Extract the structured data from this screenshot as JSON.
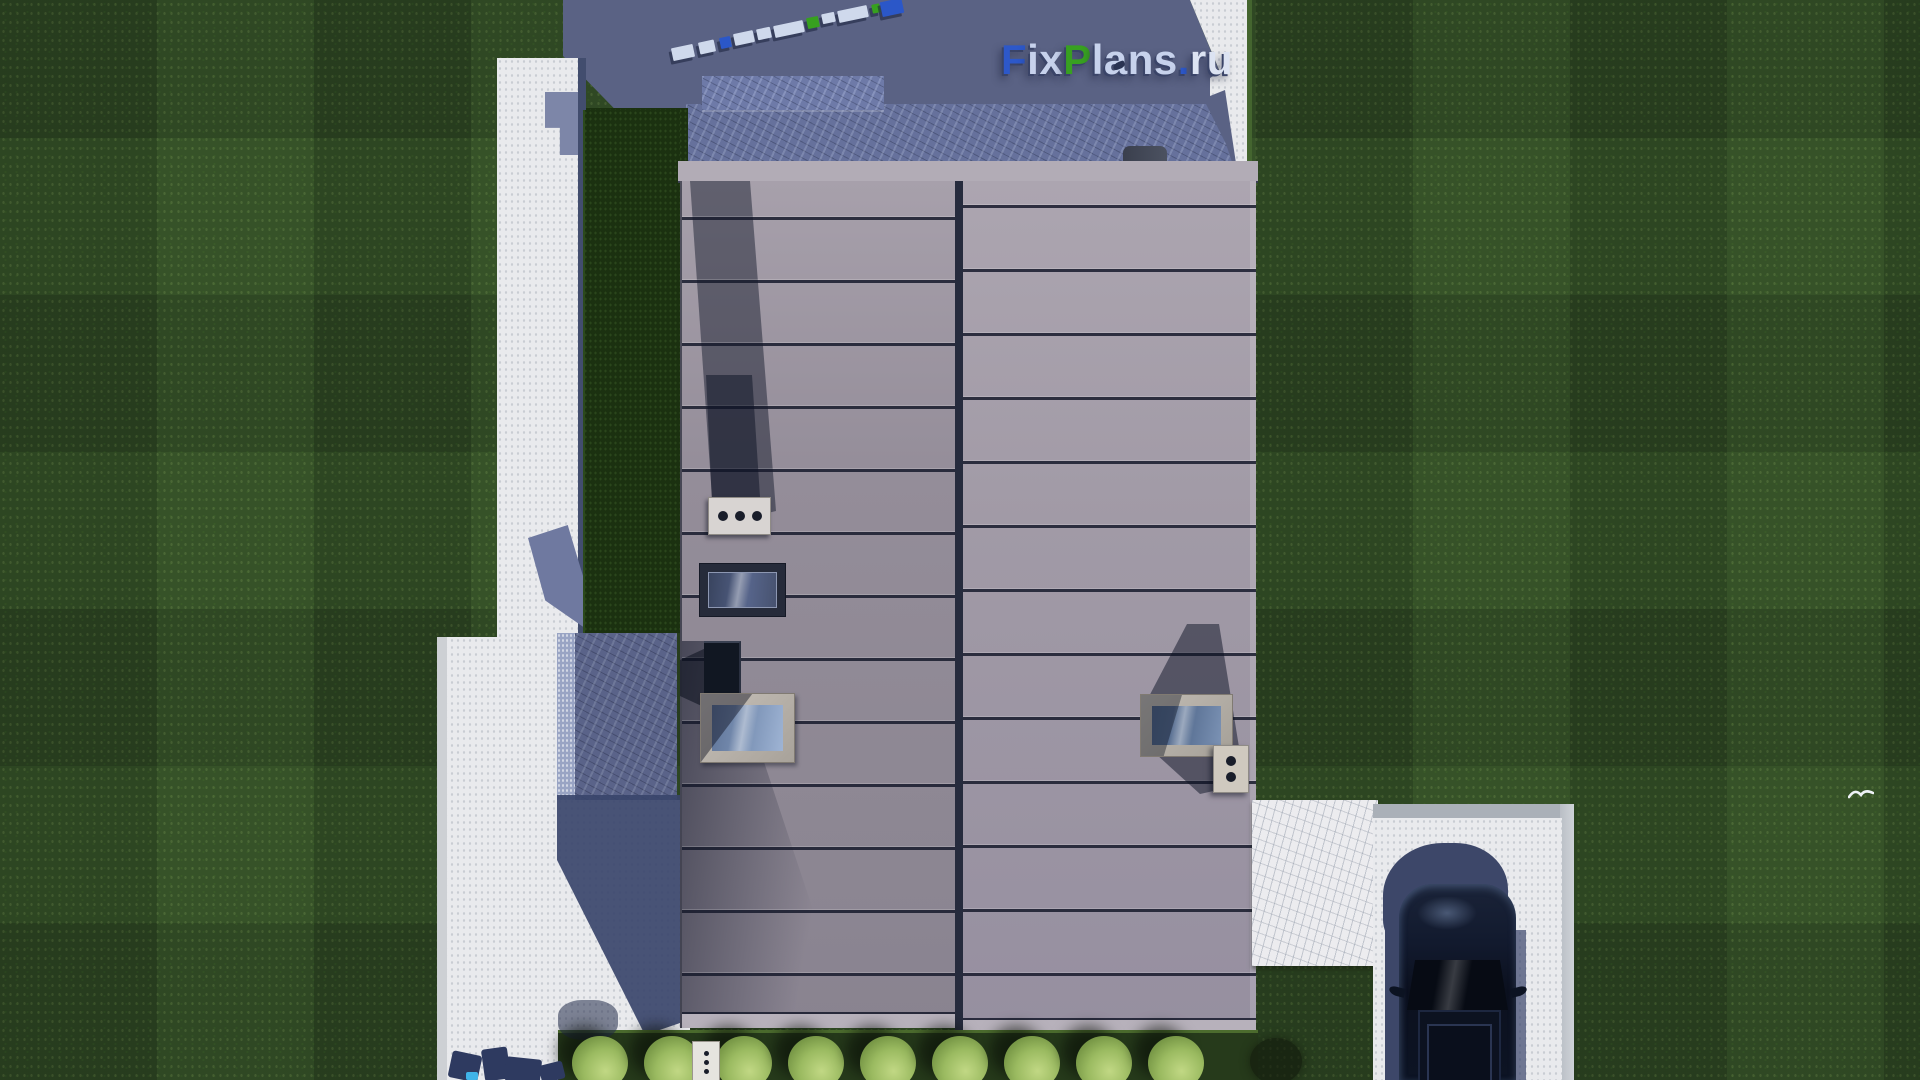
{
  "scene": {
    "description": "Aerial top-down 3D architectural render of a modern flat-roof house: two-section seamed metal roof with skylights and vents, white concrete paths, stone patios in shadow, lawn with mowing stripes, a row of trimmed shrubs, and a dark car parked on the driveway.",
    "watermark": {
      "full_text": "FixPlans.ru",
      "parts": [
        {
          "text": "F",
          "color": "#2d58c9"
        },
        {
          "text": "ix",
          "color": "#c7d2ec"
        },
        {
          "text": "P",
          "color": "#38a021"
        },
        {
          "text": "lans",
          "color": "#c7d2ec"
        },
        {
          "text": ".",
          "color": "#2d58c9"
        },
        {
          "text": "ru",
          "color": "#dce3f2"
        }
      ]
    },
    "colors": {
      "grass": "#2f4a24",
      "hedge": "#1b3110",
      "shadow": "#5a6284",
      "stone_shadowed": "#66719c",
      "path": "#e9eaed",
      "marble": "#ececef",
      "roof_left": "#948d99",
      "roof_right": "#a19aa6",
      "car_body": "#0d1424",
      "bush": "#9aba60",
      "logo_blue": "#2d58c9",
      "logo_green": "#38a021",
      "logo_light": "#c7d2ec"
    },
    "roof": {
      "left_seam_ys": [
        217,
        280,
        343,
        406,
        469,
        532,
        595,
        658,
        721,
        784,
        847,
        910,
        973
      ],
      "right_seam_ys": [
        205,
        269,
        333,
        397,
        461,
        525,
        589,
        653,
        717,
        781,
        845,
        909,
        973
      ],
      "left_vent_holes": 3,
      "right_vent_holes": 2,
      "bottom_vent_holes": 3
    },
    "landscaping": {
      "bush_count": 9,
      "bush_xs": [
        600,
        672,
        744,
        816,
        888,
        960,
        1032,
        1104,
        1176
      ]
    },
    "letters_3d": [
      {
        "x": 672,
        "y": 46,
        "w": 22,
        "h": 13,
        "c": "#cfd9ec"
      },
      {
        "x": 699,
        "y": 41,
        "w": 16,
        "h": 12,
        "c": "#cfd9ec"
      },
      {
        "x": 720,
        "y": 37,
        "w": 11,
        "h": 11,
        "c": "#2b57c8"
      },
      {
        "x": 734,
        "y": 32,
        "w": 20,
        "h": 12,
        "c": "#cfd9ec"
      },
      {
        "x": 757,
        "y": 28,
        "w": 14,
        "h": 11,
        "c": "#cfd9ec"
      },
      {
        "x": 774,
        "y": 23,
        "w": 30,
        "h": 12,
        "c": "#cfd9ec"
      },
      {
        "x": 807,
        "y": 17,
        "w": 12,
        "h": 11,
        "c": "#37a01f"
      },
      {
        "x": 822,
        "y": 13,
        "w": 13,
        "h": 10,
        "c": "#cfd9ec"
      },
      {
        "x": 838,
        "y": 8,
        "w": 30,
        "h": 12,
        "c": "#cfd9ec"
      },
      {
        "x": 872,
        "y": 4,
        "w": 8,
        "h": 9,
        "c": "#37a01f"
      },
      {
        "x": 881,
        "y": 0,
        "w": 22,
        "h": 15,
        "c": "#2b57c8"
      }
    ],
    "bottom_letter_shadows": [
      {
        "x": 450,
        "y": 1053,
        "w": 30,
        "h": 27,
        "rot": 12
      },
      {
        "x": 483,
        "y": 1048,
        "w": 26,
        "h": 32,
        "rot": -8
      },
      {
        "x": 505,
        "y": 1058,
        "w": 36,
        "h": 24,
        "rot": 6
      },
      {
        "x": 540,
        "y": 1063,
        "w": 24,
        "h": 18,
        "rot": -14
      }
    ],
    "bottom_letter_accent": {
      "x": 466,
      "y": 1072,
      "w": 12,
      "h": 8,
      "color": "#3fb3e8"
    }
  }
}
